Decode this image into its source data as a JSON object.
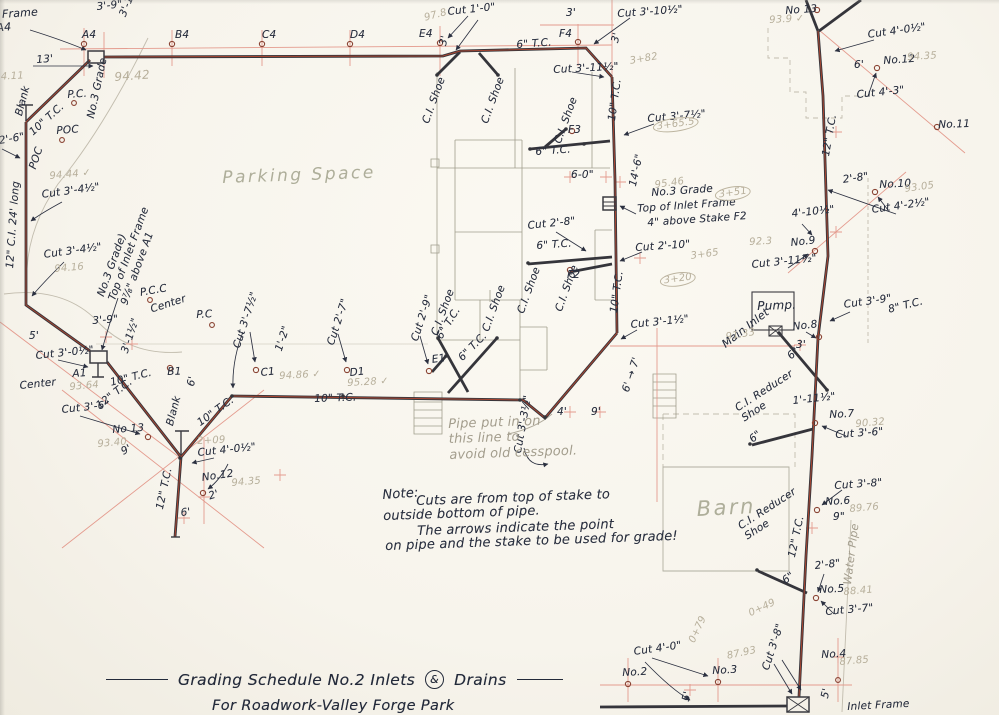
{
  "title": {
    "part1": "Grading Schedule No.2  Inlets",
    "amp": "&",
    "part2": "Drains",
    "subtitle": "For Roadwork-Valley Forge Park"
  },
  "colors": {
    "ink": "#2a3040",
    "pipe_red": "#a84531",
    "construction_red": "#e49b8e",
    "pencil": "#a39d8d"
  },
  "annotations": [
    {
      "n": "dim-3-9-top",
      "t": "3'-9\"",
      "x": 96,
      "y": 1,
      "r": -6
    },
    {
      "n": "note-below-a4",
      "t": [
        "of Inlet Frame",
        "below A4"
      ],
      "x": -42,
      "y": 12,
      "r": -4,
      "fs": 11
    },
    {
      "n": "stake-label-a4",
      "t": "A4",
      "x": 82,
      "y": 29
    },
    {
      "n": "stake-label-b4",
      "t": "B4",
      "x": 175,
      "y": 29
    },
    {
      "n": "stake-label-c4",
      "t": "C4",
      "x": 262,
      "y": 29
    },
    {
      "n": "stake-label-d4",
      "t": "D4",
      "x": 350,
      "y": 29
    },
    {
      "n": "stake-label-e4",
      "t": "E4",
      "x": 419,
      "y": 28
    },
    {
      "n": "stake-label-f4",
      "t": "F4",
      "x": 559,
      "y": 28
    },
    {
      "n": "dim-3-1h-a4",
      "t": "3'-1½\"",
      "x": 117,
      "y": 14,
      "r": -68
    },
    {
      "n": "dim-13ft",
      "t": "13'",
      "x": 36,
      "y": 54,
      "r": -4
    },
    {
      "n": "cut-1-0",
      "t": "Cut 1'-0\"",
      "x": 447,
      "y": 6,
      "r": -6
    },
    {
      "n": "dim-3ft-f4",
      "t": "3'",
      "x": 566,
      "y": 7
    },
    {
      "n": "cut-3-10h",
      "t": "Cut 3'-10½\"",
      "x": 617,
      "y": 8,
      "r": -4
    },
    {
      "n": "dim-3ft-e4",
      "t": "3'",
      "x": 437,
      "y": 44,
      "r": -75
    },
    {
      "n": "dim-3ft-f4v",
      "t": "3'",
      "x": 609,
      "y": 41,
      "r": -75
    },
    {
      "n": "pipe-label-6tc-top",
      "t": "6\" T.C.",
      "x": 516,
      "y": 39,
      "r": -4
    },
    {
      "n": "cut-3-11h-f4",
      "t": "Cut 3'-11½\"",
      "x": 553,
      "y": 64,
      "r": -3
    },
    {
      "n": "stake-label-no13-r",
      "t": "No 13",
      "x": 785,
      "y": 5,
      "r": -4
    },
    {
      "n": "cut-4-0h-r",
      "t": "Cut 4'-0½\"",
      "x": 867,
      "y": 29,
      "r": -8
    },
    {
      "n": "dim-6ft-no12r",
      "t": "6'",
      "x": 854,
      "y": 59
    },
    {
      "n": "stake-label-no12-r",
      "t": "No.12",
      "x": 883,
      "y": 55,
      "r": -4
    },
    {
      "n": "cut-4-3",
      "t": "Cut 4'-3\"",
      "x": 856,
      "y": 89,
      "r": -6
    },
    {
      "n": "stake-label-no11",
      "t": "No.11",
      "x": 938,
      "y": 119,
      "r": -2
    },
    {
      "n": "pipe-label-12tc-r",
      "t": "12\" T.C.",
      "x": 820,
      "y": 155,
      "r": -80
    },
    {
      "n": "dim-2-8-no10",
      "t": "2'-8\"",
      "x": 842,
      "y": 174,
      "r": -8
    },
    {
      "n": "stake-label-no10",
      "t": "No.10",
      "x": 879,
      "y": 179,
      "r": -3
    },
    {
      "n": "cut-4-2h",
      "t": "Cut 4'-2½\"",
      "x": 871,
      "y": 204,
      "r": -8
    },
    {
      "n": "dim-4-10h",
      "t": "4'-10½\"",
      "x": 791,
      "y": 208,
      "r": -6
    },
    {
      "n": "stake-label-no9",
      "t": "No.9",
      "x": 790,
      "y": 237,
      "r": -6
    },
    {
      "n": "cut-3-11h-no9",
      "t": "Cut 3'-11½\"",
      "x": 751,
      "y": 259,
      "r": -6
    },
    {
      "n": "cut-3-9-no8",
      "t": "Cut 3'-9\"",
      "x": 843,
      "y": 299,
      "r": -8
    },
    {
      "n": "pipe-label-8tc",
      "t": "8\" T.C.",
      "x": 887,
      "y": 304,
      "r": -14
    },
    {
      "n": "label-pump",
      "t": "Pump.",
      "x": 757,
      "y": 299,
      "r": -2,
      "fs": 12
    },
    {
      "n": "label-main-inlet",
      "t": "Main Inlet",
      "x": 720,
      "y": 341,
      "r": -38,
      "fs": 11
    },
    {
      "n": "stake-label-no8",
      "t": "No.8",
      "x": 792,
      "y": 321,
      "r": -6
    },
    {
      "n": "dim-3ft-no8",
      "t": "3'",
      "x": 796,
      "y": 339
    },
    {
      "n": "dim-6in-pump",
      "t": "6\"",
      "x": 785,
      "y": 353,
      "r": -42
    },
    {
      "n": "dim-1-11h",
      "t": "1'-11½\"",
      "x": 792,
      "y": 395,
      "r": -6
    },
    {
      "n": "stake-label-no7",
      "t": "No.7",
      "x": 829,
      "y": 409,
      "r": -3
    },
    {
      "n": "cut-3-6-no7",
      "t": "Cut 3'-6\"",
      "x": 835,
      "y": 429,
      "r": -4
    },
    {
      "n": "label-ci-reducer-1",
      "t": [
        "C.I. Reducer",
        "Shoe"
      ],
      "x": 733,
      "y": 404,
      "r": -33
    },
    {
      "n": "dim-6in-red1",
      "t": "6\"",
      "x": 747,
      "y": 436,
      "r": -40
    },
    {
      "n": "cut-3-8-no6",
      "t": "Cut 3'-8\"",
      "x": 834,
      "y": 480,
      "r": -4
    },
    {
      "n": "stake-label-no6",
      "t": "No.6",
      "x": 825,
      "y": 496,
      "r": -3
    },
    {
      "n": "dim-9in-no6",
      "t": "9\"",
      "x": 833,
      "y": 511
    },
    {
      "n": "pipe-label-12tc-low",
      "t": "12\" T.C.",
      "x": 786,
      "y": 556,
      "r": -78
    },
    {
      "n": "label-ci-reducer-2",
      "t": [
        "C.I. Reducer",
        "Shoe"
      ],
      "x": 736,
      "y": 522,
      "r": -33
    },
    {
      "n": "dim-6in-red2",
      "t": "6\"",
      "x": 780,
      "y": 577,
      "r": -38
    },
    {
      "n": "dim-2-8-no5",
      "t": "2'-8\"",
      "x": 814,
      "y": 560,
      "r": -6
    },
    {
      "n": "stake-label-no5",
      "t": "No.5",
      "x": 819,
      "y": 584,
      "r": -3
    },
    {
      "n": "cut-3-7-no5",
      "t": "Cut 3'-7\"",
      "x": 825,
      "y": 606,
      "r": -5
    },
    {
      "n": "cut-3-8-v",
      "t": "Cut 3'-8\"",
      "x": 760,
      "y": 668,
      "r": -72
    },
    {
      "n": "stake-label-no4",
      "t": "No.4",
      "x": 821,
      "y": 649,
      "r": -3
    },
    {
      "n": "dim-5ft-no4",
      "t": "5'",
      "x": 819,
      "y": 697,
      "r": -78
    },
    {
      "n": "label-inlet-frame-b",
      "t": "Inlet Frame",
      "x": 847,
      "y": 701,
      "r": -3
    },
    {
      "n": "cut-4-0",
      "t": "Cut 4'-0\"",
      "x": 633,
      "y": 646,
      "r": -8
    },
    {
      "n": "stake-label-no2",
      "t": "No.2",
      "x": 622,
      "y": 667,
      "r": -3
    },
    {
      "n": "stake-label-no3",
      "t": "No.3",
      "x": 712,
      "y": 665,
      "r": -3
    },
    {
      "n": "dim-5ft-no3",
      "t": "5'",
      "x": 680,
      "y": 700,
      "r": -78
    },
    {
      "n": "cut-3-7h-f3",
      "t": "Cut 3'-7½\"",
      "x": 647,
      "y": 113,
      "r": -5
    },
    {
      "n": "dim-14-6",
      "t": "14'-6\"",
      "x": 627,
      "y": 185,
      "r": -78
    },
    {
      "n": "dim-6-0",
      "t": "6-0\"",
      "x": 571,
      "y": 169
    },
    {
      "n": "grade-note-f2-1",
      "t": "No.3 Grade",
      "x": 651,
      "y": 187,
      "r": -4
    },
    {
      "n": "grade-note-f2-2",
      "t": "Top of Inlet Frame",
      "x": 637,
      "y": 203,
      "r": -4
    },
    {
      "n": "grade-note-f2-3",
      "t": "4\" above Stake F2",
      "x": 647,
      "y": 217,
      "r": -4
    },
    {
      "n": "cut-2-10",
      "t": "Cut 2'-10\"",
      "x": 635,
      "y": 242,
      "r": -4
    },
    {
      "n": "cut-2-8-f2",
      "t": "Cut 2'-8\"",
      "x": 527,
      "y": 220,
      "r": -6
    },
    {
      "n": "pipe-label-6tc-f2",
      "t": "6\" T.C.",
      "x": 536,
      "y": 240,
      "r": -4
    },
    {
      "n": "stake-label-f2",
      "t": "F2",
      "x": 567,
      "y": 269
    },
    {
      "n": "stake-label-f3",
      "t": "F3",
      "x": 568,
      "y": 124
    },
    {
      "n": "pipe-label-6tc-f3",
      "t": "6\" T.C.",
      "x": 535,
      "y": 146,
      "r": -4
    },
    {
      "n": "pipe-label-10tc-r1",
      "t": "10\" T.C.",
      "x": 606,
      "y": 120,
      "r": -82
    },
    {
      "n": "pipe-label-10tc-r2",
      "t": "10\" T.C.",
      "x": 608,
      "y": 312,
      "r": -82
    },
    {
      "n": "cut-3-1h",
      "t": "Cut 3'-1½\"",
      "x": 630,
      "y": 319,
      "r": -6
    },
    {
      "n": "dim-6-7",
      "t": "6' → 7'",
      "x": 620,
      "y": 390,
      "r": -72
    },
    {
      "n": "dim-4ft",
      "t": "4'",
      "x": 557,
      "y": 406
    },
    {
      "n": "dim-9ft",
      "t": "9'",
      "x": 591,
      "y": 406
    },
    {
      "n": "cut-3-3h",
      "t": "Cut 3'-3½\"",
      "x": 512,
      "y": 452,
      "r": -80
    },
    {
      "n": "label-ci-shoe-1",
      "t": "C.I. Shoe",
      "x": 420,
      "y": 121,
      "r": -70
    },
    {
      "n": "label-ci-shoe-2",
      "t": "C.I. Shoe",
      "x": 479,
      "y": 121,
      "r": -70
    },
    {
      "n": "label-ci-shoe-3",
      "t": "C.I. Shoe",
      "x": 552,
      "y": 141,
      "r": -70
    },
    {
      "n": "label-ci-shoe-4",
      "t": "C.I. Shoe",
      "x": 429,
      "y": 333,
      "r": -70
    },
    {
      "n": "label-ci-shoe-5",
      "t": "C.I. Shoe",
      "x": 480,
      "y": 329,
      "r": -70
    },
    {
      "n": "label-ci-shoe-6",
      "t": "C.I. Shoe",
      "x": 515,
      "y": 311,
      "r": -70
    },
    {
      "n": "label-ci-shoe-7",
      "t": "C.I. Shoe",
      "x": 553,
      "y": 309,
      "r": -70
    },
    {
      "n": "stake-label-e1",
      "t": "E1",
      "x": 431,
      "y": 354,
      "r": -8
    },
    {
      "n": "pipe-label-6tc-e1a",
      "t": "6\" T.C.",
      "x": 434,
      "y": 335,
      "r": -58
    },
    {
      "n": "pipe-label-6tc-e1b",
      "t": "6\" T.C.",
      "x": 456,
      "y": 355,
      "r": -45
    },
    {
      "n": "pipe-label-10tc-bottom",
      "t": "10\" T.C.",
      "x": 314,
      "y": 393,
      "r": -2
    },
    {
      "n": "cut-3-7h-c1",
      "t": "Cut 3'-7½\"",
      "x": 231,
      "y": 346,
      "r": -72
    },
    {
      "n": "dim-1-2",
      "t": "1'-2\"",
      "x": 273,
      "y": 349,
      "r": -72
    },
    {
      "n": "cut-2-7-d1",
      "t": "Cut 2'-7\"",
      "x": 325,
      "y": 343,
      "r": -72
    },
    {
      "n": "stake-label-c1",
      "t": "C1",
      "x": 260,
      "y": 367,
      "r": -6
    },
    {
      "n": "stake-label-d1",
      "t": "D1",
      "x": 349,
      "y": 367,
      "r": -6
    },
    {
      "n": "cut-2-9-e1",
      "t": "Cut 2'-9\"",
      "x": 409,
      "y": 339,
      "r": -72
    },
    {
      "n": "dim-6ft-c1",
      "t": "6'",
      "x": 185,
      "y": 385,
      "r": -78
    },
    {
      "n": "pipe-label-10tc-diag",
      "t": "10\" T.C.",
      "x": 195,
      "y": 419,
      "r": -36
    },
    {
      "n": "pipe-label-12tc-diag",
      "t": "12\" T.C.",
      "x": 94,
      "y": 402,
      "r": -38
    },
    {
      "n": "cut-3-6-no13",
      "t": "Cut 3'-6\"",
      "x": 61,
      "y": 404,
      "r": -6
    },
    {
      "n": "stake-label-no13-l",
      "t": "No 13",
      "x": 112,
      "y": 424,
      "r": -4
    },
    {
      "n": "dim-9ft-l",
      "t": "9'",
      "x": 119,
      "y": 447,
      "r": -28
    },
    {
      "n": "label-blank-j",
      "t": "Blank",
      "x": 164,
      "y": 424,
      "r": -75
    },
    {
      "n": "cut-4-0h-l",
      "t": "Cut 4'-0½\"",
      "x": 197,
      "y": 447,
      "r": -6
    },
    {
      "n": "stake-label-no12-l",
      "t": "No.12",
      "x": 201,
      "y": 472,
      "r": -8
    },
    {
      "n": "dim-2ft-l",
      "t": "2'",
      "x": 207,
      "y": 491,
      "r": -18
    },
    {
      "n": "pipe-label-12tc-v",
      "t": "12\" T.C.",
      "x": 154,
      "y": 508,
      "r": -78
    },
    {
      "n": "dim-6ft-l",
      "t": "6'",
      "x": 180,
      "y": 507,
      "r": -6
    },
    {
      "n": "cut-3-0h",
      "t": "Cut 3'-0½\"",
      "x": 35,
      "y": 350,
      "r": -6
    },
    {
      "n": "stake-label-a1",
      "t": "A1",
      "x": 72,
      "y": 368,
      "r": -4
    },
    {
      "n": "stake-label-b1",
      "t": "B1",
      "x": 167,
      "y": 366,
      "r": -2
    },
    {
      "n": "pipe-label-10tc-a1",
      "t": "10\" T.C.",
      "x": 109,
      "y": 377,
      "r": -14
    },
    {
      "n": "label-center-l",
      "t": "Center",
      "x": 19,
      "y": 380,
      "r": -6
    },
    {
      "n": "label-center-m",
      "t": "Center",
      "x": 149,
      "y": 304,
      "r": -18
    },
    {
      "n": "label-pc-m",
      "t": "P.C",
      "x": 196,
      "y": 309,
      "r": -3
    },
    {
      "n": "label-pcc",
      "t": "P.C.C",
      "x": 139,
      "y": 287,
      "r": -10
    },
    {
      "n": "dim-5ft-a1",
      "t": "5'",
      "x": 29,
      "y": 330
    },
    {
      "n": "dim-3-9-a1",
      "t": "3'-9\"",
      "x": 92,
      "y": 315,
      "r": -4
    },
    {
      "n": "dim-3-1h-a1",
      "t": "3'-1½\"",
      "x": 119,
      "y": 351,
      "r": -72
    },
    {
      "n": "cut-3-4h-1",
      "t": "Cut 3'-4½\"",
      "x": 41,
      "y": 189,
      "r": -8
    },
    {
      "n": "cut-3-4h-2",
      "t": "Cut 3'-4½\"",
      "x": 43,
      "y": 249,
      "r": -8
    },
    {
      "n": "grade-note-a1",
      "t": [
        "No.3 Grade)",
        "Top of Inlet Frame",
        "9⅞\" above A1"
      ],
      "x": 95,
      "y": 294,
      "r": -70
    },
    {
      "n": "label-no3-grade-tl",
      "t": "No.3 Grade",
      "x": 85,
      "y": 117,
      "r": -78
    },
    {
      "n": "label-blank-tl",
      "t": "Blank",
      "x": 13,
      "y": 114,
      "r": -75
    },
    {
      "n": "pipe-label-10tc-tl",
      "t": "10\" T.C.",
      "x": 27,
      "y": 129,
      "r": -42
    },
    {
      "n": "label-pc-tl",
      "t": "P.C.",
      "x": 67,
      "y": 89,
      "r": -4
    },
    {
      "n": "label-poc-1",
      "t": "POC",
      "x": 56,
      "y": 125,
      "r": -4
    },
    {
      "n": "label-poc-2",
      "t": "POC",
      "x": 27,
      "y": 167,
      "r": -72
    },
    {
      "n": "cut-2-6",
      "t": "Cut 2'-6\"",
      "x": -24,
      "y": 139,
      "r": -10
    },
    {
      "n": "pipe-label-12ci",
      "t": "12\" C.I. 24' long",
      "x": 4,
      "y": 268,
      "r": -86
    },
    {
      "n": "note-title",
      "t": "Note:",
      "x": 382,
      "y": 488,
      "fs": 13,
      "r": -4
    },
    {
      "n": "note-line-1",
      "t": "Cuts are from top of stake to",
      "x": 416,
      "y": 494,
      "fs": 13,
      "r": -2
    },
    {
      "n": "note-line-2",
      "t": "outside bottom of pipe.",
      "x": 383,
      "y": 509,
      "fs": 13,
      "r": -2
    },
    {
      "n": "note-line-3",
      "t": "The arrows indicate the point",
      "x": 417,
      "y": 524,
      "fs": 13,
      "r": -2
    },
    {
      "n": "note-line-4",
      "t": "on pipe and the stake to be used for grade!",
      "x": 385,
      "y": 539,
      "fs": 13,
      "r": -2
    },
    {
      "n": "label-parking-space",
      "t": "Parking Space",
      "x": 222,
      "y": 168,
      "fs": 17,
      "c": "pencil-lg",
      "r": -2
    },
    {
      "n": "label-barn",
      "t": "Barn",
      "x": 696,
      "y": 497,
      "fs": 21,
      "c": "pencil-lg",
      "r": -3
    },
    {
      "n": "label-water-pipe",
      "t": "Water Pipe",
      "x": 842,
      "y": 584,
      "c": "pencil",
      "r": -83,
      "fs": 11
    },
    {
      "n": "note-cesspool",
      "t": [
        "Pipe put in on",
        "this line to",
        "avoid old cesspool."
      ],
      "x": 448,
      "y": 417,
      "c": "pencil",
      "fs": 13,
      "r": -2
    },
    {
      "n": "elev-94-42",
      "t": "94.42",
      "x": 114,
      "y": 70,
      "c": "station",
      "fs": 12,
      "r": -4
    },
    {
      "n": "elev-94-44",
      "t": "94.44 ✓",
      "x": 49,
      "y": 171,
      "c": "station",
      "r": -5
    },
    {
      "n": "elev-94-16",
      "t": "94.16",
      "x": 54,
      "y": 264,
      "c": "station",
      "r": -5
    },
    {
      "n": "elev-93-64",
      "t": "93.64",
      "x": 69,
      "y": 382,
      "c": "station",
      "r": -5
    },
    {
      "n": "elev-93-40",
      "t": "93.40",
      "x": 97,
      "y": 439,
      "c": "station",
      "r": -5
    },
    {
      "n": "elev-94-35-l",
      "t": "94.35",
      "x": 231,
      "y": 478,
      "c": "station",
      "r": -5
    },
    {
      "n": "elev-94-86",
      "t": "94.86 ✓",
      "x": 279,
      "y": 371,
      "c": "station",
      "r": -3
    },
    {
      "n": "elev-95-28",
      "t": "95.28 ✓",
      "x": 347,
      "y": 378,
      "c": "station",
      "r": -3
    },
    {
      "n": "elev-93-9",
      "t": "93.9 ✓",
      "x": 769,
      "y": 15,
      "c": "station",
      "r": -3
    },
    {
      "n": "elev-94-35-r",
      "t": "94.35",
      "x": 907,
      "y": 52,
      "c": "station",
      "r": -3
    },
    {
      "n": "elev-93-05",
      "t": "93.05",
      "x": 904,
      "y": 184,
      "c": "station",
      "r": -8
    },
    {
      "n": "elev-92-3",
      "t": "92.3",
      "x": 749,
      "y": 237,
      "c": "station",
      "r": -3
    },
    {
      "n": "elev-91-33",
      "t": "91.33",
      "x": 725,
      "y": 332,
      "c": "station",
      "r": -10
    },
    {
      "n": "elev-90-32",
      "t": "90.32",
      "x": 855,
      "y": 419,
      "c": "station",
      "r": -5
    },
    {
      "n": "elev-89-76",
      "t": "89.76",
      "x": 849,
      "y": 504,
      "c": "station",
      "r": -5
    },
    {
      "n": "elev-88-41",
      "t": "88.41",
      "x": 843,
      "y": 587,
      "c": "station",
      "r": -5
    },
    {
      "n": "elev-87-85",
      "t": "87.85",
      "x": 839,
      "y": 657,
      "c": "station",
      "r": -5
    },
    {
      "n": "elev-87-93",
      "t": "87.93",
      "x": 726,
      "y": 651,
      "c": "station",
      "r": -12
    },
    {
      "n": "station-0-79",
      "t": "0+79",
      "x": 687,
      "y": 640,
      "c": "station",
      "r": -65
    },
    {
      "n": "station-0-49",
      "t": "0+49",
      "x": 747,
      "y": 609,
      "c": "station",
      "r": -25
    },
    {
      "n": "station-2-09",
      "t": "2+09",
      "x": 197,
      "y": 436,
      "c": "station",
      "r": -3
    },
    {
      "n": "station-3-82",
      "t": "3+82",
      "x": 629,
      "y": 56,
      "c": "station",
      "r": -10
    },
    {
      "n": "station-3-65-5",
      "t": "3+65.5",
      "x": 652,
      "y": 121,
      "c": "station circled",
      "r": -8
    },
    {
      "n": "station-3-51",
      "t": "3+51",
      "x": 714,
      "y": 189,
      "c": "station circled",
      "r": -8
    },
    {
      "n": "station-3-65",
      "t": "3+65",
      "x": 690,
      "y": 251,
      "c": "station",
      "r": -8
    },
    {
      "n": "station-3-20",
      "t": "3+20",
      "x": 659,
      "y": 275,
      "c": "station circled",
      "r": -8
    },
    {
      "n": "elev-95-46",
      "t": "95.46",
      "x": 654,
      "y": 180,
      "c": "station",
      "r": -8
    },
    {
      "n": "elev-94-11",
      "t": "94.11",
      "x": -6,
      "y": 72,
      "c": "station",
      "r": -3
    },
    {
      "n": "elev-97-8",
      "t": "97.8",
      "x": 423,
      "y": 13,
      "c": "station",
      "r": -15
    }
  ]
}
